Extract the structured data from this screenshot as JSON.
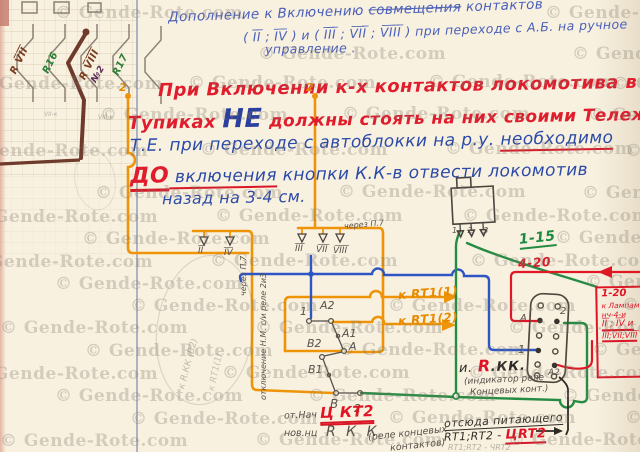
{
  "watermark": {
    "text": "© Gende-Rote.com",
    "positions": [
      [
        55,
        3
      ],
      [
        545,
        3
      ],
      [
        258,
        44
      ],
      [
        572,
        44
      ],
      [
        -25,
        74
      ],
      [
        188,
        73
      ],
      [
        428,
        72
      ],
      [
        612,
        74
      ],
      [
        100,
        105
      ],
      [
        342,
        104
      ],
      [
        588,
        105
      ],
      [
        -40,
        141
      ],
      [
        200,
        140
      ],
      [
        445,
        139
      ],
      [
        625,
        141
      ],
      [
        95,
        183
      ],
      [
        338,
        182
      ],
      [
        582,
        183
      ],
      [
        -30,
        207
      ],
      [
        215,
        206
      ],
      [
        462,
        206
      ],
      [
        82,
        229
      ],
      [
        555,
        228
      ],
      [
        -35,
        252
      ],
      [
        210,
        251
      ],
      [
        470,
        251
      ],
      [
        55,
        274
      ],
      [
        585,
        272
      ],
      [
        130,
        296
      ],
      [
        388,
        296
      ],
      [
        622,
        295
      ],
      [
        0,
        318
      ],
      [
        255,
        318
      ],
      [
        508,
        318
      ],
      [
        85,
        341
      ],
      [
        338,
        340
      ],
      [
        592,
        340
      ],
      [
        -30,
        364
      ],
      [
        222,
        363
      ],
      [
        468,
        363
      ],
      [
        55,
        386
      ],
      [
        308,
        386
      ],
      [
        562,
        386
      ],
      [
        130,
        409
      ],
      [
        388,
        408
      ],
      [
        625,
        408
      ],
      [
        0,
        431
      ],
      [
        255,
        430
      ],
      [
        508,
        430
      ]
    ]
  },
  "header": {
    "line1_a": "Дополнение к Включению ",
    "line1_strike": "совмещения",
    "line1_b": " контактов",
    "line2": "( I̅I̅ ; I̅V̅ ) и ( I̅I̅I̅ ; V̅I̅I̅ ; V̅I̅I̅I̅ )  при переходе с А.Б. на ручное",
    "line3": "управление ."
  },
  "note": {
    "p1": "При Включении к-х контактов локомотива в",
    "p2_word": "Тупиках",
    "p2_ne": "НЕ",
    "p2_rest": "должны стоять на них своими Тележками.",
    "p3_a": "Т.Е. при переходе с автоблокки на р.у. ",
    "p3_b": "необходимо",
    "p4_do": "ДО",
    "p4_b": " включения",
    "p4_c": " кнопки К.К-в отвести локомотив",
    "p5": "назад на 3-4 см."
  },
  "switch_block": {
    "labels": [
      "R V̅I̅I̅",
      "R16",
      "R V̅I̅I̅I̅",
      "№2",
      "R17"
    ],
    "terminal_left": "2",
    "terminal_right": "2",
    "note_left": "VII-к",
    "note_right": "VIII-к"
  },
  "contacts": {
    "row1": [
      "I̅I̅",
      "I̅V̅"
    ],
    "row2": [
      "I̅I̅I̅",
      "V̅I̅I̅",
      "V̅I̅I̅I̅"
    ],
    "cherez_p7": "через П.7"
  },
  "pencil_vertical": {
    "p7": "через П.7",
    "otkl": "отключение Н.М. с/и реле 2и3"
  },
  "relay": {
    "c1": "1",
    "a2": "A2",
    "a1": "A1",
    "a": "A",
    "b2": "B2",
    "b1": "B1",
    "b": "B",
    "two": "2",
    "k_rt1_1": "к RT1(1)",
    "k_rt1_2": "к RT1(2)"
  },
  "limit_box": {
    "terminals": "1 2 3"
  },
  "links": {
    "green_range": "1-15",
    "red_range": "4-20"
  },
  "red_box": {
    "l1": "1-20",
    "l2": "к Лампам",
    "l3": "нч-4-и",
    "l4": "I̅I̅ ; I̅V̅ и",
    "l5": "I̅I̅I̅;V̅I̅I̅;V̅I̅I̅I̅"
  },
  "connector": {
    "pin_a": "A",
    "pin_2": "2",
    "pin_1": "1",
    "pin_a2": "A2"
  },
  "rkk": {
    "i": "и.",
    "r": "R",
    "kk": ".КК.",
    "ind1": "(индикатор реле",
    "ind2": "Концевых конт.)"
  },
  "feed": {
    "l1": "отсюда питающего",
    "l2a": "RT1;RT2 - ",
    "l2b": "ЦRT2",
    "faint": "RТ1;RТ2 - ЧRТ2"
  },
  "bottom_notes": {
    "ot_nach": "от.Нач",
    "u_kt2": "Ц КТ2",
    "nov": "нов.нц",
    "rkk": "R К К",
    "rel1": "(реле концевых",
    "rel2": "контактов)"
  },
  "faint_notes": {
    "e1": "к R.КК (В2)",
    "e2": "к RТ1(1)"
  }
}
